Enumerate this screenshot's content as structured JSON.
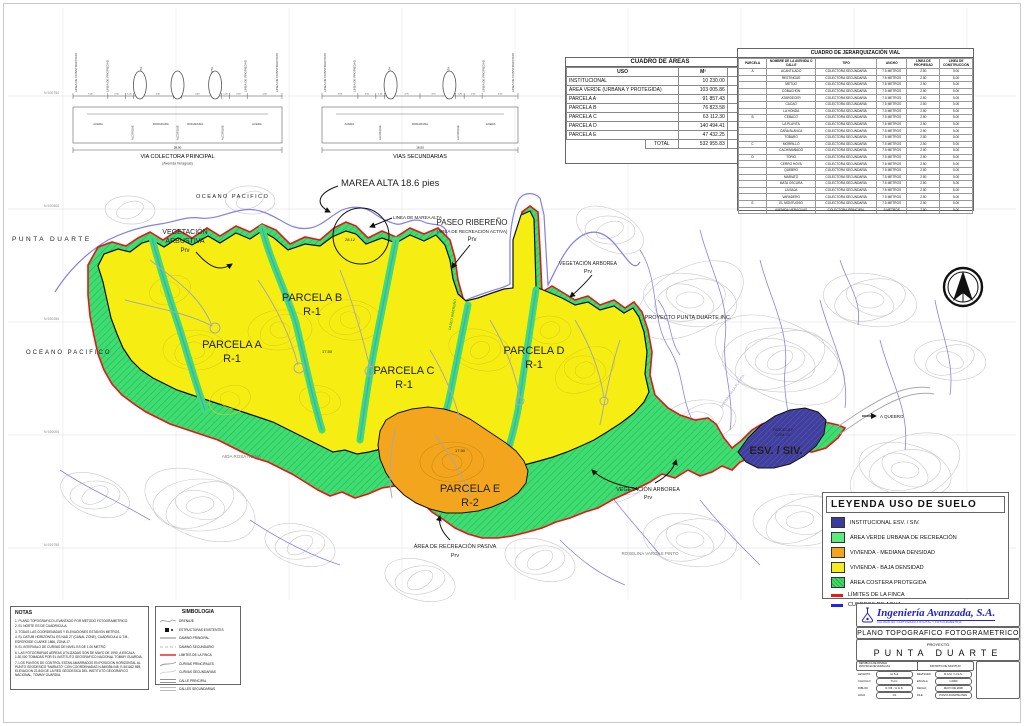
{
  "sheet": {
    "grid_labels": [
      "N 920750",
      "N 920500",
      "N 920250",
      "N 920000",
      "N 919750"
    ]
  },
  "cross_sections": {
    "principal": {
      "title": "VIA COLECTORA PRINCIPAL",
      "subtitle": "(Avenida Veraguas)",
      "total_width": "28.00",
      "top_labels": [
        "LINEA DE CONSTRUCCION",
        "LINEA DE PROPIEDAD",
        "CUNETA ABIERTA",
        "CUNETA ABIERTA",
        "LINEA DE PROPIEDAD",
        "LINEA DE CONSTRUCCION"
      ],
      "bottom_labels": [
        "ACERA",
        "ALCORQUE",
        "RODADURA",
        "ALCORQUE",
        "RODADURA",
        "ALCORQUE",
        "ACERA"
      ],
      "dims": [
        "5.00",
        "2.50",
        "1.20",
        "1.20",
        "4.50",
        "1.20",
        "4.50",
        "1.20",
        "1.20",
        "2.50",
        "5.00"
      ]
    },
    "secundarias": {
      "title": "VIAS SECUNDARIAS",
      "subtitle": "",
      "total_width": "18.50",
      "top_labels": [
        "LINEA DE CONSTRUCCION",
        "LINEA DE PROPIEDAD",
        "CUNETA ABIERTA",
        "CUNETA ABIERTA",
        "LINEA DE PROPIEDAD",
        "LINEA DE CONSTRUCCION"
      ],
      "bottom_labels": [
        "ACERA",
        "ALCORQUE",
        "RODADURA",
        "ALCORQUE",
        "ACERA"
      ],
      "dims": [
        "5.00",
        "2.50",
        "1.20",
        "1.20",
        "3.75",
        "3.75",
        "1.20",
        "1.20",
        "2.50",
        "5.00"
      ]
    }
  },
  "area_table": {
    "title": "CUADRO DE ÁREAS",
    "headers": [
      "USO",
      "M²",
      "%"
    ],
    "rows": [
      [
        "INSTITUCIONAL",
        "10 230.00",
        "2%"
      ],
      [
        "ÁREA VERDE (URBANA Y PROTEGIDA)",
        "103 005.86",
        "19%"
      ],
      [
        "PARCELA A",
        "91 857.43",
        "17%"
      ],
      [
        "PARCELA B",
        "76 823.58",
        "15%"
      ],
      [
        "PARCELA C",
        "63 112.30",
        "12%"
      ],
      [
        "PARCELA D",
        "140 494.41",
        "26%"
      ],
      [
        "PARCELA E",
        "47 432.25",
        "9%"
      ]
    ],
    "total_label": "TOTAL",
    "total_value": "532 955.83",
    "total_pct": "100%"
  },
  "road_table": {
    "title": "CUADRO DE JERARQUIZACIÓN VIAL",
    "headers": [
      "PARCELA",
      "NOMBRE DE LA AVENIDA O CALLE",
      "TIPO",
      "ANCHO",
      "LÍNEA DE PROPIEDAD",
      "LÍNEA DE CONSTRUCCIÓN"
    ],
    "rows": [
      [
        "A",
        "ACANTILADO",
        "COLECTORA SECUNDARIA",
        "7.5 METROS",
        "2.50",
        "5.00"
      ],
      [
        "",
        "RESTINGUE",
        "COLECTORA SECUNDARIA",
        "7.5 METROS",
        "2.50",
        "5.00"
      ],
      [
        "",
        "METIJO",
        "COLECTORA SECUNDARIA",
        "7.5 METROS",
        "2.50",
        "5.00"
      ],
      [
        "",
        "COBACHÓN",
        "COLECTORA SECUNDARIA",
        "7.5 METROS",
        "2.50",
        "5.00"
      ],
      [
        "",
        "ATARDECER",
        "COLECTORA SECUNDARIA",
        "7.5 METROS",
        "2.50",
        "5.00"
      ],
      [
        "",
        "CACAO",
        "COLECTORA SECUNDARIA",
        "7.5 METROS",
        "2.50",
        "5.00"
      ],
      [
        "",
        "LA HONDA",
        "COLECTORA SECUNDARIA",
        "7.5 METROS",
        "2.50",
        "5.00"
      ],
      [
        "B",
        "CEBACO",
        "COLECTORA SECUNDARIA",
        "7.5 METROS",
        "2.50",
        "5.00"
      ],
      [
        "",
        "LA PLAYITA",
        "COLECTORA SECUNDARIA",
        "7.5 METROS",
        "2.50",
        "5.00"
      ],
      [
        "",
        "CAÑA BLANCA",
        "COLECTORA SECUNDARIA",
        "7.5 METROS",
        "2.50",
        "5.00"
      ],
      [
        "",
        "TOBARO",
        "COLECTORA SECUNDARIA",
        "7.5 METROS",
        "2.50",
        "5.00"
      ],
      [
        "C",
        "MORRILLO",
        "COLECTORA SECUNDARIA",
        "7.5 METROS",
        "2.50",
        "5.00"
      ],
      [
        "",
        "CACHIMAÑADO",
        "COLECTORA SECUNDARIA",
        "7.5 METROS",
        "2.50",
        "5.00"
      ],
      [
        "D",
        "TORIO",
        "COLECTORA SECUNDARIA",
        "7.5 METROS",
        "2.50",
        "5.00"
      ],
      [
        "",
        "CERRO HOYA",
        "COLECTORA SECUNDARIA",
        "7.5 METROS",
        "2.50",
        "5.00"
      ],
      [
        "",
        "QUEBRO",
        "COLECTORA SECUNDARIA",
        "7.5 METROS",
        "2.50",
        "5.00"
      ],
      [
        "",
        "MARIATO",
        "COLECTORA SECUNDARIA",
        "7.5 METROS",
        "2.50",
        "5.00"
      ],
      [
        "",
        "MATA OSCURA",
        "COLECTORA SECUNDARIA",
        "7.5 METROS",
        "2.50",
        "5.00"
      ],
      [
        "",
        "LA BAJA",
        "COLECTORA SECUNDARIA",
        "7.5 METROS",
        "2.50",
        "5.00"
      ],
      [
        "",
        "VARADERO",
        "COLECTORA SECUNDARIA",
        "7.5 METROS",
        "2.50",
        "5.00"
      ],
      [
        "E",
        "EL MONTUOSO",
        "COLECTORA SECUNDARIA",
        "7.5 METROS",
        "2.50",
        "5.00"
      ],
      [
        "",
        "AVENIDA VERAGUAS",
        "COLECTORA PRINCIPAL",
        "9 METROS",
        "2.50",
        "5.00"
      ]
    ]
  },
  "legend": {
    "title": "LEYENDA USO DE SUELO",
    "items": [
      {
        "swatch": "navy",
        "label": "INSTITUCIONAL ESV. / SIV."
      },
      {
        "swatch": "green",
        "label": "ÁREA VERDE URBANA DE RECREACIÓN"
      },
      {
        "swatch": "orange",
        "label": "VIVIENDA - MEDIANA DENSIDAD"
      },
      {
        "swatch": "yellow",
        "label": "VIVIENDA - BAJA DENSIDAD"
      },
      {
        "swatch": "hatch",
        "label": "ÁREA COSTERA PROTEGIDA"
      },
      {
        "swatch": "redline",
        "label": "LÍMITES DE LA FINCA"
      },
      {
        "swatch": "blueline",
        "label": "CUERPOS DE AGUA"
      }
    ],
    "colors": {
      "navy": "#3d3b99",
      "green": "#5ce97e",
      "orange": "#f2a51d",
      "yellow": "#f5ec1e",
      "hatch": "#3fdc66",
      "redline": "#e91c1c",
      "blueline": "#2222ee"
    }
  },
  "map": {
    "punta_duarte": "PUNTA DUARTE",
    "oceano_left": "OCEANO PACIFICO",
    "oceano_top": "OCEANO PACIFICO",
    "marea_alta": "MAREA ALTA 18.6 pies",
    "linea_marea": "LINEA DE MAREA ALTA",
    "marea_dim": "28.12",
    "dim_1750": "17.50",
    "veg_arbustiva": "VEGETACIÓN",
    "veg_arbustiva2": "ARBUSTIVA",
    "prv": "Prv",
    "parcela_a": "PARCELA A",
    "parcela_b": "PARCELA B",
    "parcela_c": "PARCELA C",
    "parcela_d": "PARCELA D",
    "parcela_e": "PARCELA E",
    "r1": "R-1",
    "r2": "R-2",
    "paseo": "PASEO RIBEREÑO",
    "paseo_sub": "(AREA DE RECREACIÓN ACTIVA)",
    "paseo_strip": "PASEO RIBEREÑO",
    "veg_arborea": "VEGETACIÓN ARBOREA",
    "proyecto_inc": "PROYECTO PUNTA DUARTE INC.",
    "recreacion_pasiva": "ÁREA DE RECREACIÓN PASIVA",
    "aida": "AIDA ROSA REINA",
    "roselina": "ROSELINA VARGAS PINTO",
    "esv": "ESV. / SIV.",
    "parcela_f": "PARCELA F",
    "com": "COM. M.",
    "a_quebro": "A QUEBRO",
    "quebrada": "QUEBRADA LA PLAYITA"
  },
  "notes": {
    "title": "NOTAS",
    "items": [
      "1. PLANO TOPOGRAFICO LEVANTADO POR METODO FOTOGRAMETRICO.",
      "2. EL NORTE ES DE CUADRICULA.",
      "3. TODAS LAS COORDENADAS Y ELEVACIONES ESTAN EN METROS.",
      "4. EL DATUM HORIZONTAL ES NAD 27 (CANAL ZONE), CUADRICULA U.T.M., ESFEROIDE CLARKE 1866, ZONA 17.",
      "5. EL INTERVALO DE CURVAS DE NIVEL ES DE 1.00 METRO.",
      "6. LAS FOTOGRAFIAS AEREAS UTILIZADAS SON DE MAYO DE 1990, A ESCALA 1:30,000 TOMADAS POR EL INSTITUTO GEOGRAFICO NACIONAL TOMMY GUARDIA.",
      "7. LOS PUNTOS DE CONTROL ESTAN AMARRADOS EN POSICION HORIZONTAL AL PUNTO GEODESICO \"MARIATO\" CON COORDENADAS N-849356.048, E-501162.559, ELEVACION 22.840 DE LA RED GEODESICA DEL INSTITUTO GEOGRAFICO NACIONAL, TOMMY GUARDIA."
    ]
  },
  "symbols": {
    "title": "SIMBOLOGIA",
    "items": [
      "DRENAJE",
      "ESTRUCTURAS EXISTENTES",
      "CAMINO PRINCIPAL",
      "CAMINO SECUNDARIO",
      "LIMITES DE LA FINCA",
      "CURVAS PRINCIPALES",
      "CURVAS SECUNDARIAS",
      "CALLE PRINCIPAL",
      "CALLES SECUNDARIAS"
    ]
  },
  "title_block": {
    "company": "Ingeniería Avanzada, S.A.",
    "tagline": "CALIDAD EN CARTOGRAFIA DIGITAL Y FOTOGRAMETRIA",
    "plan_title": "PLANO TOPOGRAFICO FOTOGRAMETRICO",
    "project_label": "PROYECTO",
    "project_name": "PUNTA DUARTE",
    "location_line1": "REPUBLICA DE PANAMA",
    "location_line2": "PROVINCIA DE VERAGUAS",
    "location_right": "DISTRITO DE MONTIJO",
    "fields": [
      {
        "label": "LEVANTO",
        "value": "I.A.S.A."
      },
      {
        "label": "REVISADO",
        "value": "R.A.M. / H.G.S."
      },
      {
        "label": "CALCULO",
        "value": "T.H.C."
      },
      {
        "label": "ESCALA",
        "value": "1:2000"
      },
      {
        "label": "DIBUJO",
        "value": "D.V.B. / H.G.S."
      },
      {
        "label": "FECHA",
        "value": "MAYO DE 2008"
      },
      {
        "label": "HOJA",
        "value": "1/1"
      },
      {
        "label": "FILE",
        "value": "PUNTA DUARTE.DWG"
      }
    ]
  }
}
